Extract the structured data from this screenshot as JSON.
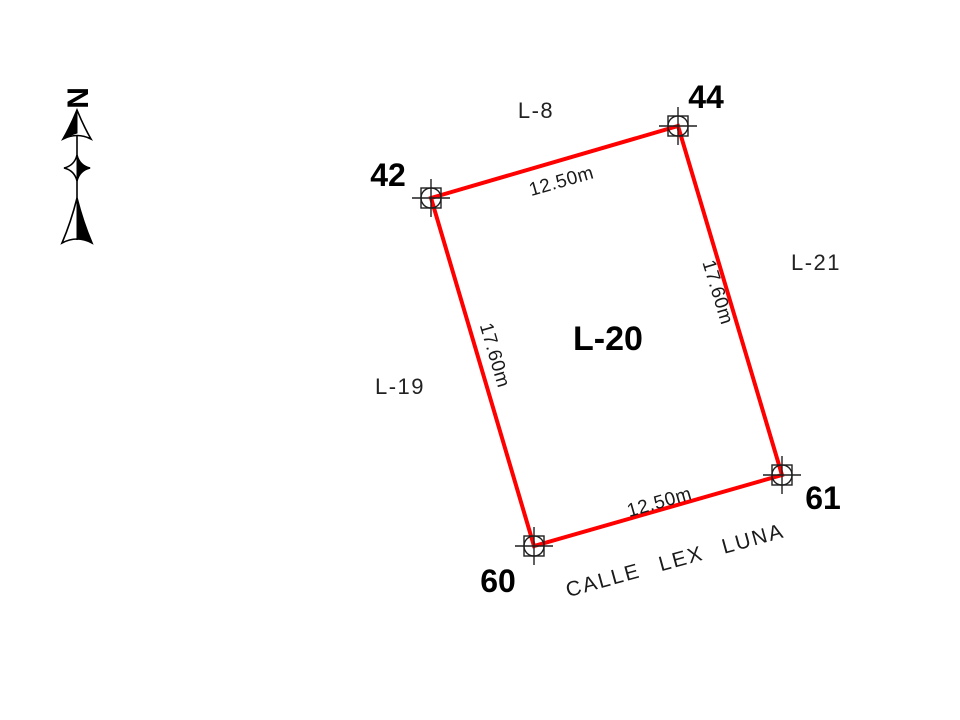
{
  "colors": {
    "parcel_line": "#ff0000",
    "ink": "#000000"
  },
  "north_indicator": {
    "label": "N"
  },
  "parcel": {
    "id_label": "L-20",
    "corners": [
      {
        "point": "42"
      },
      {
        "point": "44"
      },
      {
        "point": "61"
      },
      {
        "point": "60"
      }
    ],
    "side_dimensions": {
      "top": "12.50m",
      "right": "17.60m",
      "bottom": "12.50m",
      "left": "17.60m"
    }
  },
  "adjacent_lots": {
    "north": "L-8",
    "east": "L-21",
    "west": "L-19"
  },
  "street": {
    "name": "CALLE LEX LUNA"
  }
}
